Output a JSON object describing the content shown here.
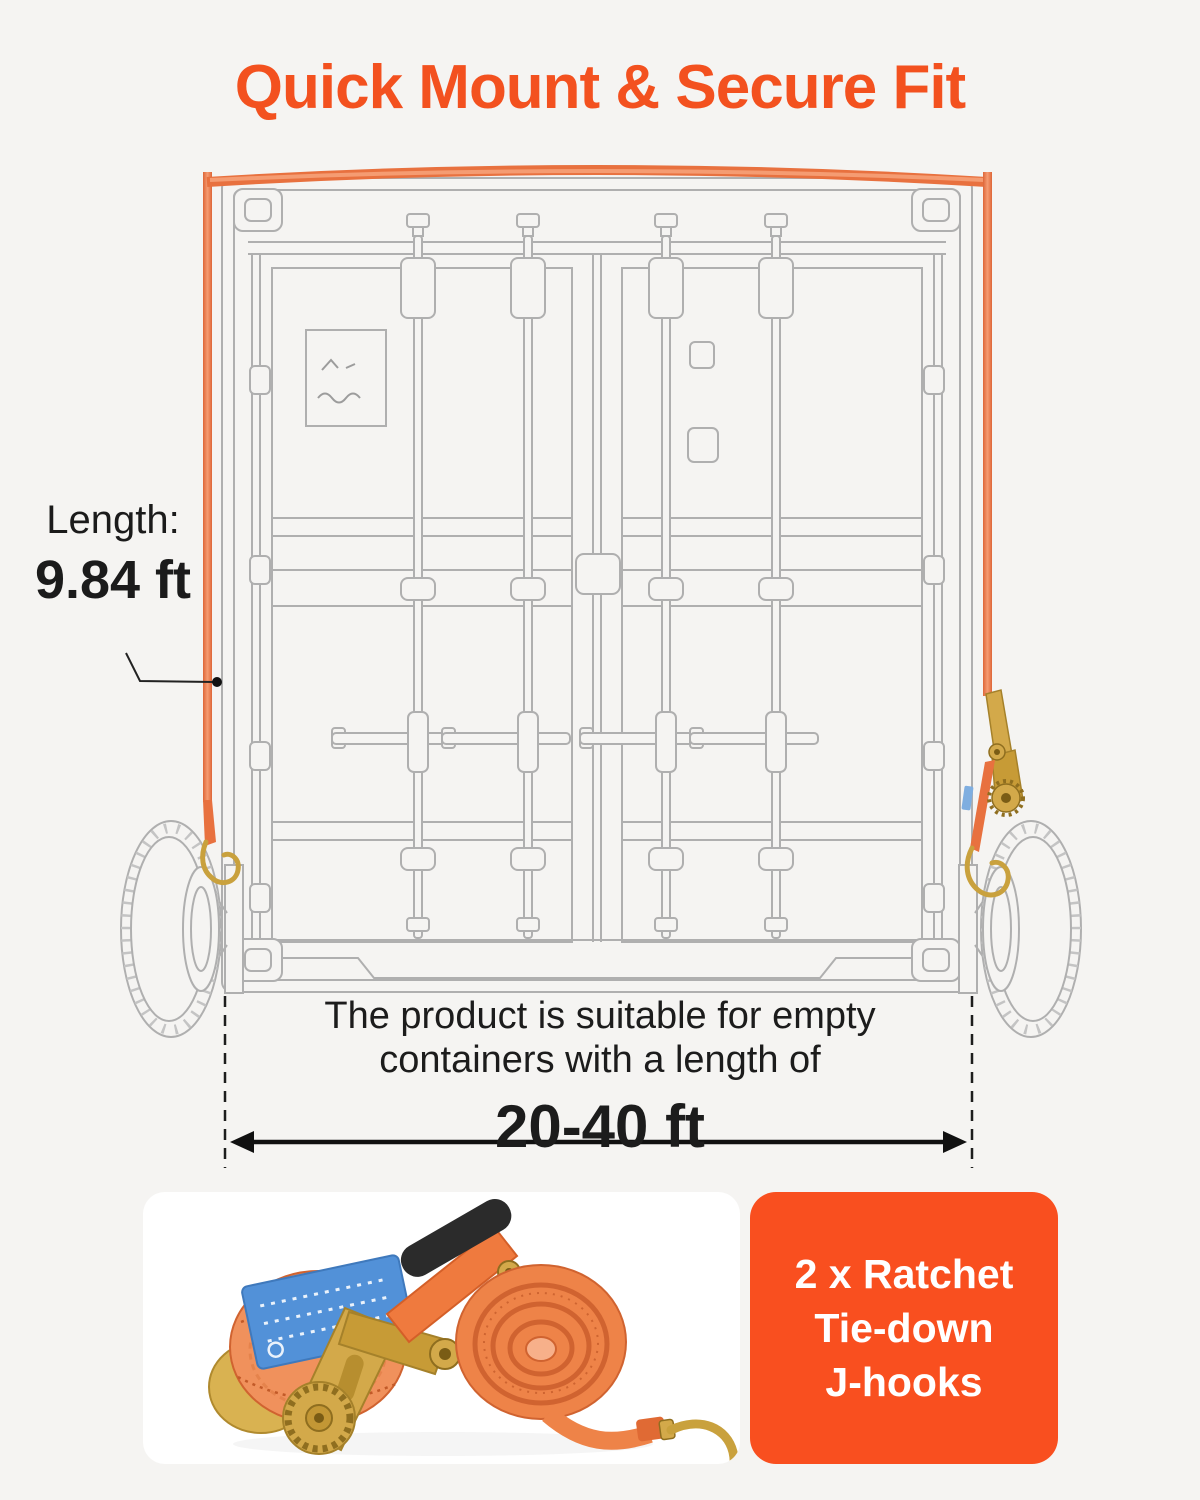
{
  "background_color": "#F5F4F2",
  "title": {
    "text": "Quick Mount & Secure Fit",
    "color": "#F3511F"
  },
  "length_callout": {
    "label": "Length:",
    "value": "9.84 ft"
  },
  "container_note": {
    "line1": "The product is suitable for empty",
    "line2": "containers with a length of",
    "range": "20-40 ft"
  },
  "included_card": {
    "lines": [
      "2 x Ratchet",
      "Tie-down",
      "J-hooks"
    ],
    "background_color": "#F94F1F",
    "text_color": "#FFFFFF"
  },
  "diagram": {
    "illustration": "shipping-container-rear-with-strap",
    "strap_color": "#E8713F",
    "outline_color": "#AFAFAF",
    "hardware_color": "#C9A13D",
    "strap_label_tag_color": "#5291D8"
  }
}
